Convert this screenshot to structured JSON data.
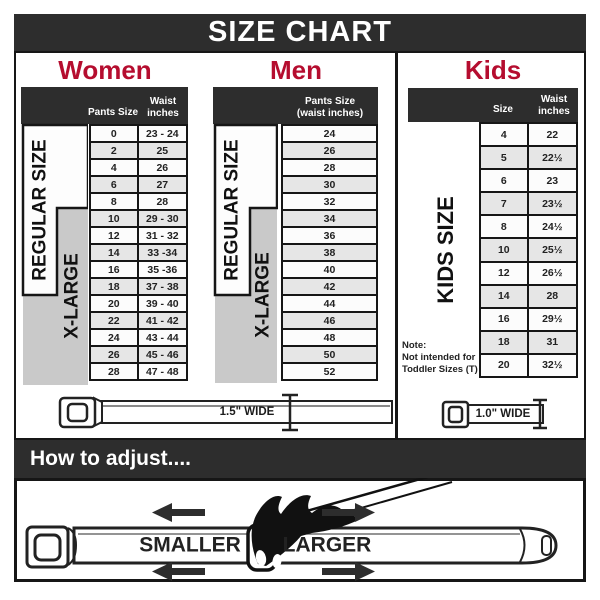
{
  "title": "SIZE CHART",
  "colors": {
    "accent_red": "#b50d2f",
    "dark_bar": "#2d2d2d",
    "row_alt": "#e6e6e6",
    "xlarge_gray": "#c9c9c9"
  },
  "sections": {
    "women": {
      "heading": "Women",
      "column_headers": {
        "pants_size": "Pants Size",
        "waist": "Waist\ninches"
      },
      "size_group_labels": {
        "regular": "REGULAR SIZE",
        "xlarge": "X-LARGE"
      },
      "rows": [
        [
          "0",
          "23 - 24"
        ],
        [
          "2",
          "25"
        ],
        [
          "4",
          "26"
        ],
        [
          "6",
          "27"
        ],
        [
          "8",
          "28"
        ],
        [
          "10",
          "29 - 30"
        ],
        [
          "12",
          "31 - 32"
        ],
        [
          "14",
          "33 -34"
        ],
        [
          "16",
          "35 -36"
        ],
        [
          "18",
          "37 - 38"
        ],
        [
          "20",
          "39 - 40"
        ],
        [
          "22",
          "41 - 42"
        ],
        [
          "24",
          "43 - 44"
        ],
        [
          "26",
          "45 - 46"
        ],
        [
          "28",
          "47 - 48"
        ]
      ]
    },
    "men": {
      "heading": "Men",
      "column_headers": {
        "pants_size": "Pants Size\n(waist inches)"
      },
      "size_group_labels": {
        "regular": "REGULAR SIZE",
        "xlarge": "X-LARGE"
      },
      "rows": [
        "24",
        "26",
        "28",
        "30",
        "32",
        "34",
        "36",
        "38",
        "40",
        "42",
        "44",
        "46",
        "48",
        "50",
        "52"
      ]
    },
    "kids": {
      "heading": "Kids",
      "column_headers": {
        "size": "Size",
        "waist": "Waist\ninches"
      },
      "size_group_label": "KIDS SIZE",
      "note": "Note:\nNot intended for\nToddler Sizes (T)",
      "rows": [
        [
          "4",
          "22"
        ],
        [
          "5",
          "22½"
        ],
        [
          "6",
          "23"
        ],
        [
          "7",
          "23½"
        ],
        [
          "8",
          "24½"
        ],
        [
          "10",
          "25½"
        ],
        [
          "12",
          "26½"
        ],
        [
          "14",
          "28"
        ],
        [
          "16",
          "29½"
        ],
        [
          "18",
          "31"
        ],
        [
          "20",
          "32½"
        ]
      ]
    }
  },
  "belts": {
    "adult_width_label": "1.5\" WIDE",
    "kids_width_label": "1.0\" WIDE"
  },
  "adjust_section": {
    "heading": "How to adjust....",
    "smaller_label": "SMALLER",
    "larger_label": "LARGER"
  }
}
